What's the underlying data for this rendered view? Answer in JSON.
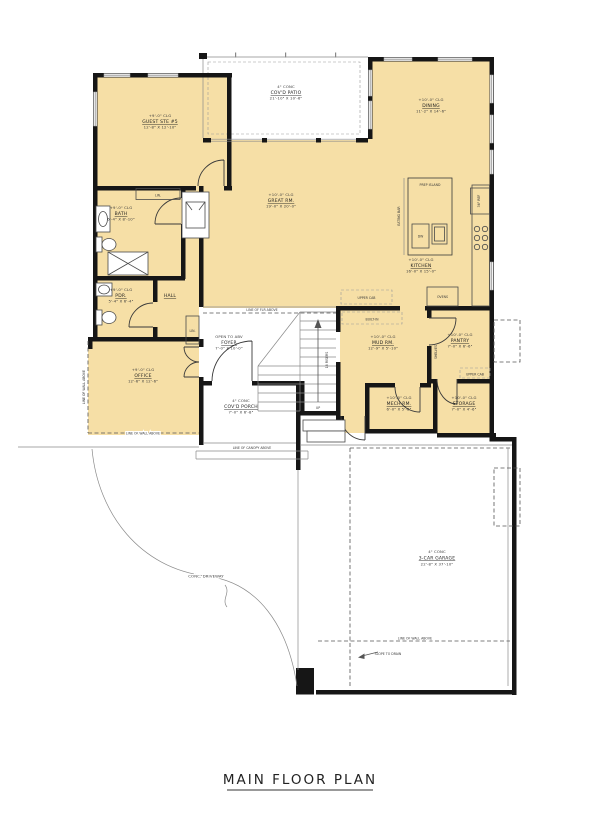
{
  "title": "MAIN FLOOR PLAN",
  "rooms": {
    "guest_suite": {
      "ceiling": "+9'-0\" CLG",
      "name": "GUEST STE #5",
      "dims": "12'-8\" X 12'-10\""
    },
    "bath": {
      "ceiling": "+9'-0\" CLG",
      "name": "BATH",
      "dims": "6'-4\" X 8'-10\""
    },
    "pdr": {
      "ceiling": "+9'-0\" CLG",
      "name": "PDR.",
      "dims": "5'-4\" X 6'-4\""
    },
    "hall": {
      "name": "HALL"
    },
    "office": {
      "ceiling": "+9'-0\" CLG",
      "name": "OFFICE",
      "dims": "12'-6\" X 12'-6\""
    },
    "foyer": {
      "ceiling": "OPEN TO ABV",
      "name": "FOYER",
      "dims": "7'-0\" X 10'-0\""
    },
    "great_room": {
      "ceiling": "+10'-0\" CLG",
      "name": "GREAT RM.",
      "dims": "19'-0\" X 20'-0\""
    },
    "dining": {
      "ceiling": "+10'-0\" CLG",
      "name": "DINING",
      "dims": "11'-2\" X 14'-6\""
    },
    "kitchen": {
      "ceiling": "+10'-0\" CLG",
      "name": "KITCHEN",
      "dims": "16'-0\" X 15'-0\""
    },
    "mud_room": {
      "ceiling": "+10'-0\" CLG",
      "name": "MUD RM.",
      "dims": "12'-9\" X 5'-10\""
    },
    "pantry": {
      "ceiling": "+10'-0\" CLG",
      "name": "PANTRY",
      "dims": "7'-0\" X 6'-6\""
    },
    "mech_room": {
      "ceiling": "+10'-0\" CLG",
      "name": "MECH RM.",
      "dims": "6'-0\" X 5'-8\""
    },
    "storage": {
      "ceiling": "+10'-0\" CLG",
      "name": "STORAGE",
      "dims": "7'-0\" X 4'-6\""
    },
    "covered_patio": {
      "ceiling": "4\" CONC",
      "name": "COV'D PATIO",
      "dims": "21'-10\" X 10'-6\""
    },
    "covered_porch": {
      "ceiling": "4\" CONC",
      "name": "COV'D PORCH",
      "dims": "7'-0\" X 6'-8\""
    },
    "garage": {
      "ceiling": "4\" CONC",
      "name": "3-CAR GARAGE",
      "dims": "22'-8\" X 37'-10\""
    }
  },
  "annotations": {
    "driveway": "CONC. DRIVEWAY",
    "line_flr_above": "LINE OF FLR ABOVE",
    "line_wall_above": "LINE OF WALL ABOVE",
    "line_canopy_above": "LINE OF CANOPY ABOVE",
    "slope_to_drain": "SLOPE TO DRAIN",
    "risers": "18 RISERS",
    "up": "UP",
    "prep_island": "PREP ISLAND",
    "dw": "DW",
    "eating_bar": "EATING BAR",
    "ref_36": "36\" REF",
    "ovens": "OVENS",
    "upper_cab": "UPPER CAB",
    "built_in": "BUILT-IN",
    "shelves": "SHELVES",
    "linen": "LIN."
  },
  "colors": {
    "room_fill": "#f6dfa6",
    "wall": "#161616",
    "line": "#555555"
  }
}
